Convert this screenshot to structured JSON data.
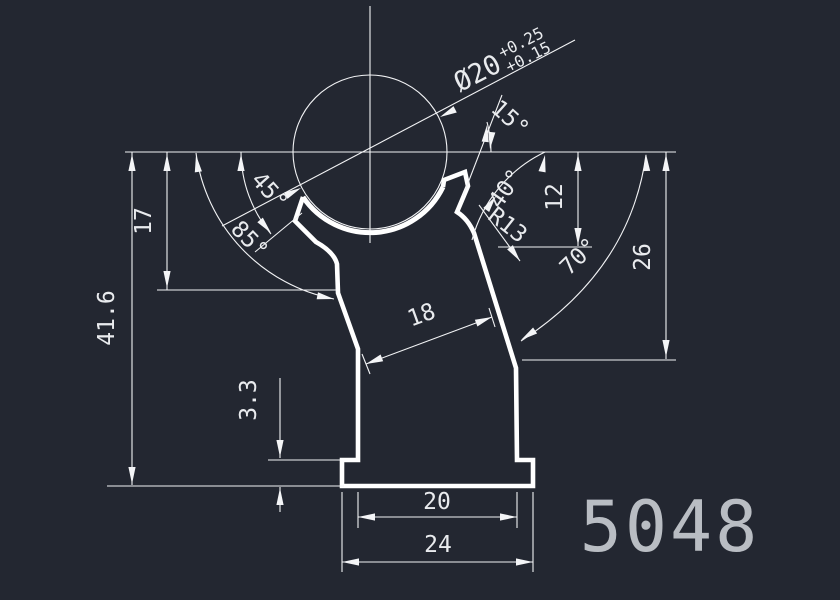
{
  "drawing": {
    "part_number": "5048",
    "colors": {
      "background": "#232731",
      "outline": "#ffffff",
      "dimension_lines": "#f2f3f5",
      "dimension_text": "#e9ebee",
      "title_text": "#b9bdc3"
    },
    "dimensions": {
      "diameter": {
        "value": "Ø20",
        "tol_upper": "+0.25",
        "tol_lower": "+0.15"
      },
      "height_total": "41.6",
      "height_waist": "17",
      "flange_height": "3.3",
      "depth_right_upper": "12",
      "depth_right": "26",
      "neck_width": "18",
      "body_width": "20",
      "flange_width": "24",
      "angle_left_lip": "45°",
      "angle_left": "85°",
      "angle_right_lip": "15°",
      "angle_right_upper": "40°",
      "angle_right": "70°",
      "socket_radius": "R13"
    }
  }
}
